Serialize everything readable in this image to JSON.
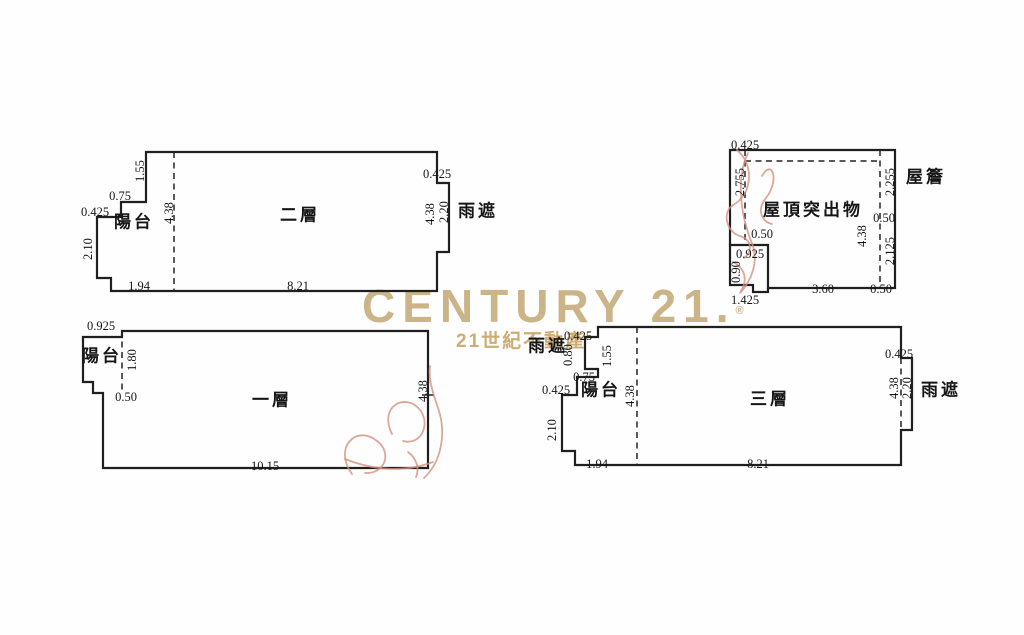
{
  "watermark": {
    "brand": "CENTURY 21.",
    "registered": "®",
    "tagline": "21世紀不動產",
    "brand_color": "#c6ac7b",
    "tagline_color": "#c9a76b"
  },
  "ink_color": "#1f1f1f",
  "pen_mark_color": "#d4907e",
  "plans": {
    "floor2": {
      "title": "二層",
      "labels": [
        {
          "t": "1.55",
          "x": 140,
          "y": 171,
          "rot": 1
        },
        {
          "t": "0.75",
          "x": 120,
          "y": 196,
          "rot": 0
        },
        {
          "t": "0.425",
          "x": 95,
          "y": 212,
          "rot": 0
        },
        {
          "t": "陽台",
          "x": 134,
          "y": 222,
          "rot": 0,
          "cjk": 1
        },
        {
          "t": "4.38",
          "x": 169,
          "y": 213,
          "rot": 1
        },
        {
          "t": "二層",
          "x": 300,
          "y": 215,
          "rot": 0,
          "cjk": 1
        },
        {
          "t": "2.10",
          "x": 88,
          "y": 249,
          "rot": 1
        },
        {
          "t": "1.94",
          "x": 139,
          "y": 286,
          "rot": 0
        },
        {
          "t": "8.21",
          "x": 298,
          "y": 286,
          "rot": 0
        },
        {
          "t": "0.425",
          "x": 437,
          "y": 174,
          "rot": 0
        },
        {
          "t": "4.38",
          "x": 430,
          "y": 214,
          "rot": 1
        },
        {
          "t": "2.20",
          "x": 444,
          "y": 212,
          "rot": 1
        },
        {
          "t": "雨遮",
          "x": 478,
          "y": 211,
          "rot": 0,
          "cjk": 1
        }
      ]
    },
    "roof_projection": {
      "title": "屋頂突出物",
      "labels": [
        {
          "t": "0.425",
          "x": 745,
          "y": 145,
          "rot": 0
        },
        {
          "t": "2.755",
          "x": 740,
          "y": 182,
          "rot": 1
        },
        {
          "t": "屋頂突出物",
          "x": 813,
          "y": 210,
          "rot": 0,
          "cjk": 1
        },
        {
          "t": "0.50",
          "x": 762,
          "y": 234,
          "rot": 0
        },
        {
          "t": "0.925",
          "x": 750,
          "y": 254,
          "rot": 0
        },
        {
          "t": "0.90",
          "x": 736,
          "y": 272,
          "rot": 1
        },
        {
          "t": "1.425",
          "x": 745,
          "y": 300,
          "rot": 0
        },
        {
          "t": "3.60",
          "x": 823,
          "y": 289,
          "rot": 0
        },
        {
          "t": "0.50",
          "x": 881,
          "y": 289,
          "rot": 0
        },
        {
          "t": "0.50",
          "x": 884,
          "y": 218,
          "rot": 0
        },
        {
          "t": "4.38",
          "x": 862,
          "y": 236,
          "rot": 1
        },
        {
          "t": "2.255",
          "x": 890,
          "y": 182,
          "rot": 1
        },
        {
          "t": "2.125",
          "x": 890,
          "y": 251,
          "rot": 1
        },
        {
          "t": "屋簷",
          "x": 926,
          "y": 177,
          "rot": 0,
          "cjk": 1
        }
      ]
    },
    "floor1": {
      "title": "一層",
      "labels": [
        {
          "t": "0.925",
          "x": 101,
          "y": 326,
          "rot": 0
        },
        {
          "t": "陽台",
          "x": 102,
          "y": 356,
          "rot": 0,
          "cjk": 1
        },
        {
          "t": "1.80",
          "x": 132,
          "y": 360,
          "rot": 1
        },
        {
          "t": "0.50",
          "x": 126,
          "y": 397,
          "rot": 0
        },
        {
          "t": "一層",
          "x": 272,
          "y": 400,
          "rot": 0,
          "cjk": 1
        },
        {
          "t": "10.15",
          "x": 265,
          "y": 466,
          "rot": 0
        },
        {
          "t": "4.38",
          "x": 423,
          "y": 391,
          "rot": 1
        }
      ]
    },
    "floor3": {
      "title": "三層",
      "labels": [
        {
          "t": "雨遮",
          "x": 548,
          "y": 346,
          "rot": 0,
          "cjk": 1
        },
        {
          "t": "0.425",
          "x": 578,
          "y": 336,
          "rot": 0
        },
        {
          "t": "0.80",
          "x": 568,
          "y": 355,
          "rot": 1
        },
        {
          "t": "1.55",
          "x": 607,
          "y": 356,
          "rot": 1
        },
        {
          "t": "0.75",
          "x": 584,
          "y": 377,
          "rot": 0
        },
        {
          "t": "0.425",
          "x": 556,
          "y": 390,
          "rot": 0
        },
        {
          "t": "陽台",
          "x": 601,
          "y": 390,
          "rot": 0,
          "cjk": 1
        },
        {
          "t": "4.38",
          "x": 630,
          "y": 396,
          "rot": 1
        },
        {
          "t": "三層",
          "x": 770,
          "y": 399,
          "rot": 0,
          "cjk": 1
        },
        {
          "t": "2.10",
          "x": 552,
          "y": 430,
          "rot": 1
        },
        {
          "t": "1.94",
          "x": 597,
          "y": 464,
          "rot": 0
        },
        {
          "t": "8.21",
          "x": 758,
          "y": 464,
          "rot": 0
        },
        {
          "t": "0.425",
          "x": 899,
          "y": 354,
          "rot": 0
        },
        {
          "t": "4.38",
          "x": 894,
          "y": 388,
          "rot": 1
        },
        {
          "t": "2.20",
          "x": 907,
          "y": 388,
          "rot": 1
        },
        {
          "t": "雨遮",
          "x": 941,
          "y": 390,
          "rot": 0,
          "cjk": 1
        }
      ]
    }
  }
}
